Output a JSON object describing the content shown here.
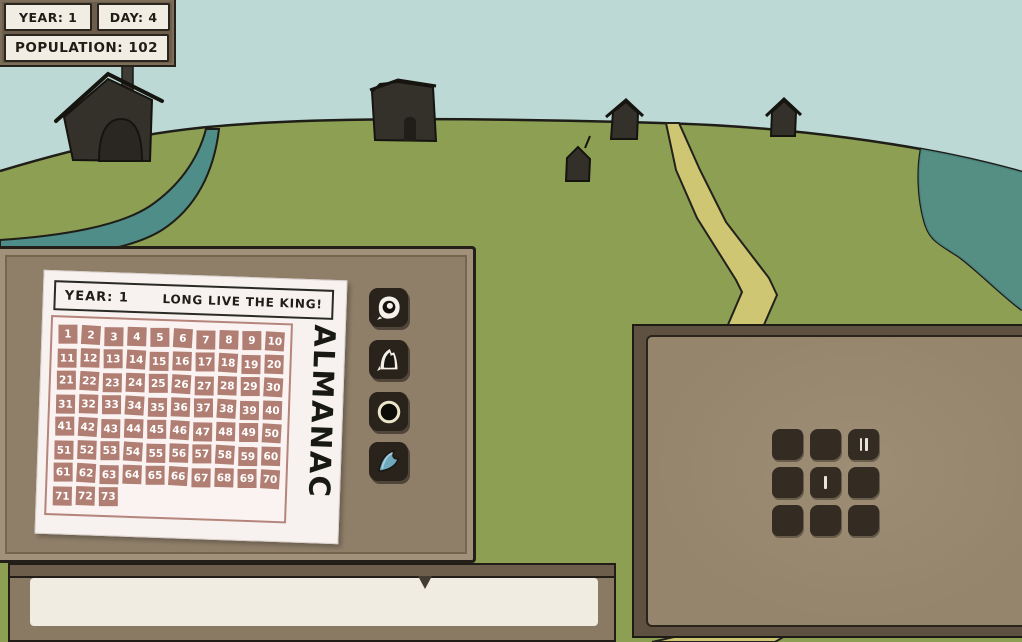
{
  "hud": {
    "year_label": "YEAR: 1",
    "day_label": "DAY: 4",
    "population_label": "POPULATION: 102"
  },
  "almanac": {
    "title_vertical": "ALMANAC",
    "header_left": "YEAR: 1",
    "header_right": "LONG LIVE THE KING!",
    "days": [
      1,
      2,
      3,
      4,
      5,
      6,
      7,
      8,
      9,
      10,
      11,
      12,
      13,
      14,
      15,
      16,
      17,
      18,
      19,
      20,
      21,
      22,
      23,
      24,
      25,
      26,
      27,
      28,
      29,
      30,
      31,
      32,
      33,
      34,
      35,
      36,
      37,
      38,
      39,
      40,
      41,
      42,
      43,
      44,
      45,
      46,
      47,
      48,
      49,
      50,
      51,
      52,
      53,
      54,
      55,
      56,
      57,
      58,
      59,
      60,
      61,
      62,
      63,
      64,
      65,
      66,
      67,
      68,
      69,
      70,
      71,
      72,
      73
    ],
    "icons": [
      "eye",
      "rat",
      "moon",
      "wave"
    ]
  },
  "building_grid": {
    "tallies": [
      0,
      0,
      2,
      0,
      1,
      0,
      0,
      0,
      0
    ]
  },
  "dialog": {
    "text": ""
  },
  "colors": {
    "sky": "#bcd9d5",
    "grass": "#8c9f52",
    "water": "#4f8d88",
    "path": "#cec673",
    "panel_wood": "#6d5e4b",
    "panel_body": "#95856d",
    "paper": "#f7f1ef",
    "calendar_cell": "#b17e73",
    "wave_blue": "#6fa9bd",
    "ink": "#1f1d18"
  }
}
